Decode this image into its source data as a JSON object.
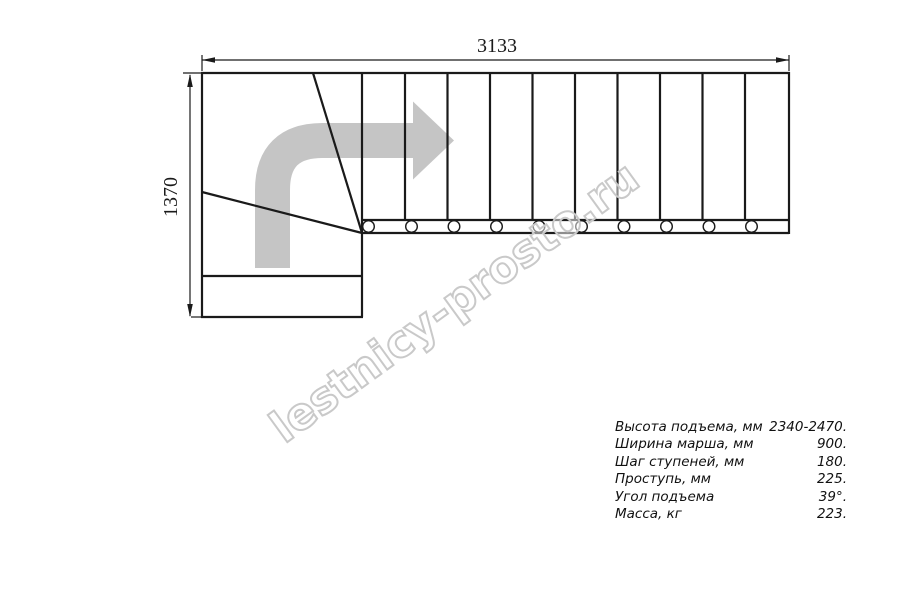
{
  "page": {
    "background": "#ffffff",
    "line_color": "#1a1a1a"
  },
  "drawing": {
    "title": "staircase-plan-top-view",
    "top_dimension_label": "3133",
    "left_dimension_label": "1370"
  },
  "direction_arrow": {
    "meaning": "travel-direction-turn-right",
    "color": "#c5c5c5"
  },
  "watermark": {
    "text": "lestnicy-prosto.ru",
    "stroke_color": "#c9c9c9"
  },
  "specs": {
    "rows": [
      {
        "label": "Высота подъема, мм",
        "value": "2340-2470."
      },
      {
        "label": "Ширина марша, мм",
        "value": "900."
      },
      {
        "label": "Шаг ступеней, мм",
        "value": "180."
      },
      {
        "label": "Проступь, мм",
        "value": "225."
      },
      {
        "label": "Угол подъема",
        "value": "39°."
      },
      {
        "label": "Масса, кг",
        "value": "223."
      }
    ]
  }
}
